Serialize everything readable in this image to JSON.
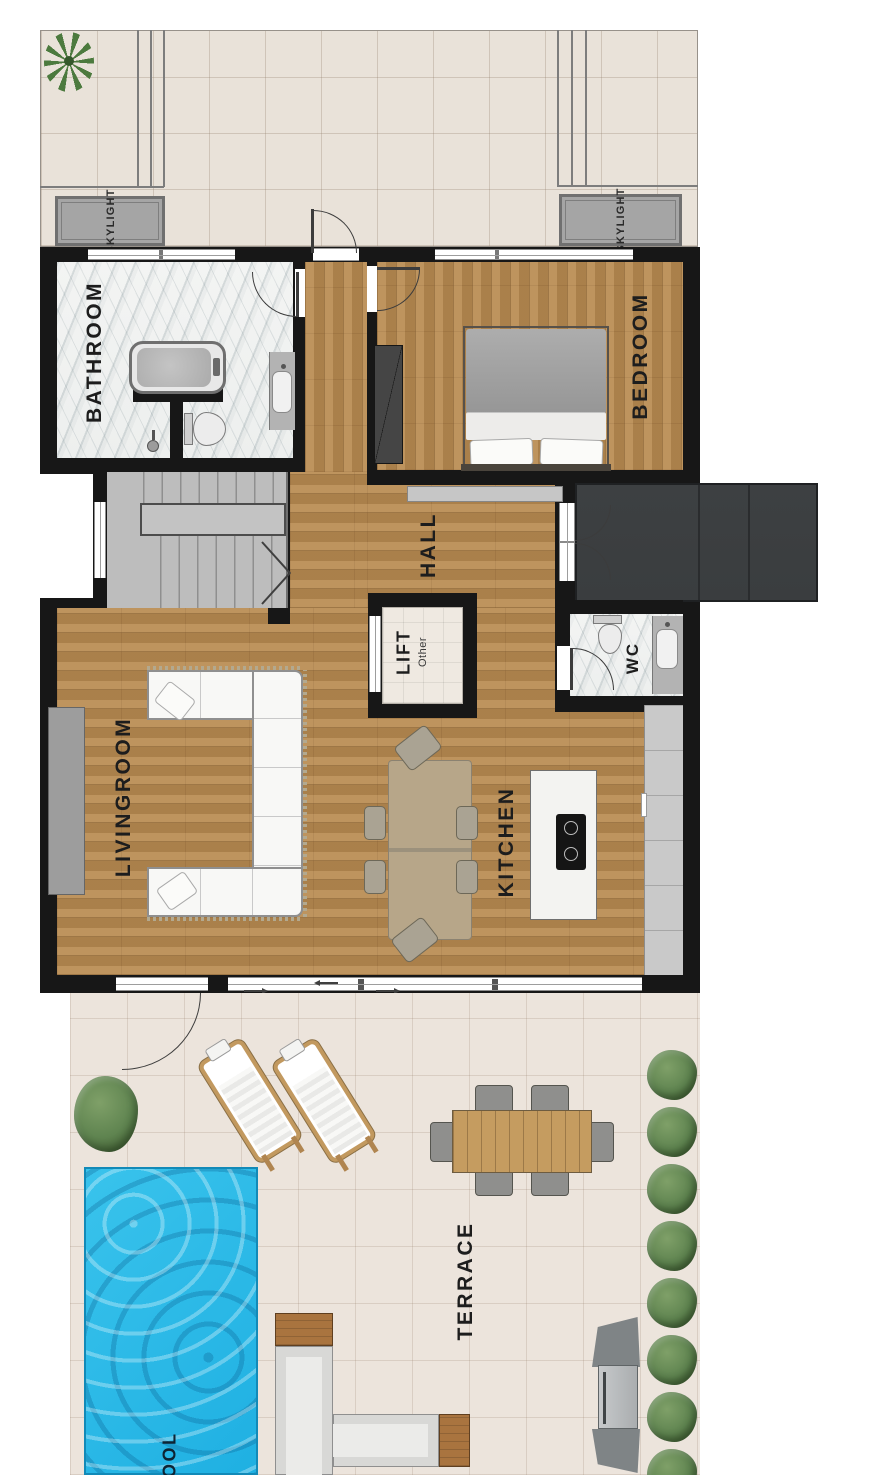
{
  "plan": {
    "rooms": {
      "bathroom": "BATHROOM",
      "bedroom": "BEDROOM",
      "hall": "HALL",
      "lift": "LIFT",
      "lift_type": "Other",
      "wc": "WC",
      "livingroom": "LIVINGROOM",
      "kitchen": "KITCHEN",
      "terrace": "TERRACE",
      "pool": "POOL"
    },
    "annotations": {
      "skylight_left": "SKYLIGHT",
      "skylight_right": "SKYLIGHT"
    },
    "colors": {
      "wall": "#171717",
      "wood_floor": "#b78a52",
      "marble": "#f3f4f3",
      "roof_tile": "#e9e2d9",
      "terrace_tile": "#ece4dc",
      "pool_water": "#1fb0e2",
      "deck_dark": "#3a3d3f",
      "stair_gray": "#bdbdbd",
      "skylight_gray": "#a5a5a5",
      "plant_green": "#5f8450",
      "label_text": "#1d1d1d",
      "pool_label": "#0e2433"
    }
  }
}
